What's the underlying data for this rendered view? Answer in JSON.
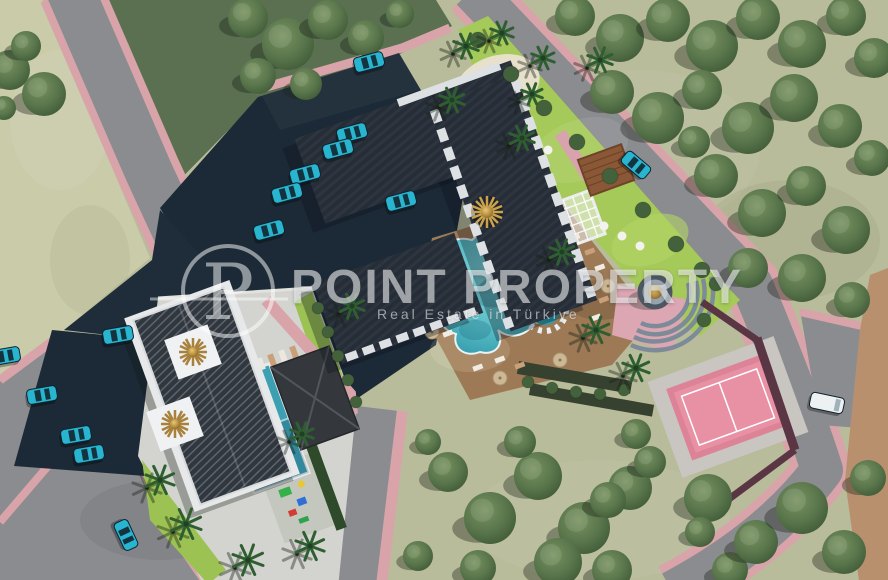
{
  "watermark": {
    "logo_letter": "P",
    "title": "POINT PROPERTY",
    "tagline": "Real Estate in Türkiye"
  },
  "palette": {
    "scrub_grass": "#b8bc9a",
    "pale_field": "#c9cba9",
    "dark_grass": "#5a7050",
    "road_gray": "#8b8c90",
    "sidewalk_pink": "#d8a4a9",
    "curb_maroon": "#6b4048",
    "asphalt_navy": "#1c2a37",
    "roof_charcoal": "#262d36",
    "lawn_green": "#a6ca5a",
    "pool_teal": "#3fa9b8",
    "deck_brown": "#9d7a55",
    "court_pink": "#e2879b",
    "gold": "#b58d3f",
    "car_teal": "#29b4cf",
    "van_white": "#eef1f2",
    "tree_green": "#53714a",
    "palm_green": "#2f5f31",
    "bush_green": "#43613a",
    "tan_strip": "#b9906e",
    "watermark_white": "rgba(255,255,255,0.55)"
  },
  "scene": {
    "label": "aerial-3d-site-plan-render",
    "trees": [
      [
        575,
        16,
        20
      ],
      [
        620,
        38,
        24
      ],
      [
        668,
        20,
        22
      ],
      [
        712,
        46,
        26
      ],
      [
        758,
        18,
        22
      ],
      [
        802,
        44,
        24
      ],
      [
        846,
        16,
        20
      ],
      [
        874,
        58,
        20
      ],
      [
        612,
        92,
        22
      ],
      [
        658,
        118,
        26
      ],
      [
        702,
        90,
        20
      ],
      [
        748,
        128,
        26
      ],
      [
        794,
        98,
        24
      ],
      [
        840,
        126,
        22
      ],
      [
        872,
        158,
        18
      ],
      [
        716,
        176,
        22
      ],
      [
        762,
        213,
        24
      ],
      [
        806,
        186,
        20
      ],
      [
        846,
        230,
        24
      ],
      [
        748,
        268,
        20
      ],
      [
        802,
        278,
        24
      ],
      [
        852,
        300,
        18
      ],
      [
        694,
        142,
        16
      ],
      [
        248,
        18,
        20
      ],
      [
        288,
        44,
        26
      ],
      [
        328,
        20,
        20
      ],
      [
        366,
        38,
        18
      ],
      [
        400,
        14,
        14
      ],
      [
        258,
        76,
        18
      ],
      [
        306,
        84,
        16
      ],
      [
        10,
        70,
        20
      ],
      [
        44,
        94,
        22
      ],
      [
        26,
        46,
        15
      ],
      [
        4,
        108,
        12
      ],
      [
        448,
        472,
        20
      ],
      [
        490,
        518,
        26
      ],
      [
        538,
        476,
        24
      ],
      [
        584,
        528,
        26
      ],
      [
        630,
        488,
        22
      ],
      [
        558,
        562,
        24
      ],
      [
        612,
        570,
        20
      ],
      [
        730,
        570,
        18
      ],
      [
        708,
        498,
        24
      ],
      [
        756,
        542,
        22
      ],
      [
        802,
        508,
        26
      ],
      [
        844,
        552,
        22
      ],
      [
        868,
        478,
        18
      ],
      [
        478,
        568,
        18
      ],
      [
        428,
        442,
        13
      ],
      [
        520,
        442,
        16
      ],
      [
        636,
        434,
        15
      ],
      [
        650,
        462,
        16
      ],
      [
        418,
        556,
        15
      ],
      [
        608,
        500,
        18
      ],
      [
        700,
        532,
        15
      ]
    ],
    "palms": [
      [
        466,
        46,
        13
      ],
      [
        502,
        33,
        12
      ],
      [
        452,
        100,
        13
      ],
      [
        543,
        58,
        12
      ],
      [
        522,
        138,
        13
      ],
      [
        600,
        60,
        13
      ],
      [
        532,
        94,
        11
      ],
      [
        562,
        252,
        13
      ],
      [
        596,
        330,
        14
      ],
      [
        636,
        368,
        14
      ],
      [
        160,
        480,
        15
      ],
      [
        186,
        524,
        16
      ],
      [
        248,
        560,
        16
      ],
      [
        310,
        546,
        15
      ],
      [
        352,
        306,
        13
      ],
      [
        302,
        434,
        12
      ]
    ],
    "bushes": [
      [
        478,
        40,
        8
      ],
      [
        511,
        74,
        8
      ],
      [
        544,
        108,
        8
      ],
      [
        577,
        142,
        8
      ],
      [
        610,
        176,
        8
      ],
      [
        643,
        210,
        8
      ],
      [
        676,
        244,
        8
      ],
      [
        702,
        270,
        8
      ],
      [
        318,
        308,
        6
      ],
      [
        328,
        332,
        6
      ],
      [
        338,
        356,
        6
      ],
      [
        348,
        380,
        6
      ],
      [
        356,
        402,
        6
      ],
      [
        528,
        382,
        6
      ],
      [
        552,
        388,
        6
      ],
      [
        576,
        392,
        6
      ],
      [
        600,
        394,
        6
      ],
      [
        624,
        390,
        6
      ],
      [
        716,
        284,
        7
      ],
      [
        704,
        320,
        7
      ]
    ],
    "cars": [
      {
        "x": 352,
        "y": 133,
        "rot": -15,
        "kind": "car"
      },
      {
        "x": 338,
        "y": 149,
        "rot": -15,
        "kind": "car"
      },
      {
        "x": 305,
        "y": 174,
        "rot": -15,
        "kind": "car"
      },
      {
        "x": 287,
        "y": 193,
        "rot": -15,
        "kind": "car"
      },
      {
        "x": 269,
        "y": 230,
        "rot": -15,
        "kind": "car"
      },
      {
        "x": 401,
        "y": 201,
        "rot": -15,
        "kind": "car"
      },
      {
        "x": 369,
        "y": 62,
        "rot": -15,
        "kind": "car"
      },
      {
        "x": 42,
        "y": 395,
        "rot": -10,
        "kind": "car"
      },
      {
        "x": 76,
        "y": 435,
        "rot": -10,
        "kind": "car"
      },
      {
        "x": 89,
        "y": 454,
        "rot": -10,
        "kind": "car"
      },
      {
        "x": 118,
        "y": 335,
        "rot": -10,
        "kind": "car"
      },
      {
        "x": 5,
        "y": 356,
        "rot": -10,
        "kind": "car"
      },
      {
        "x": 636,
        "y": 165,
        "rot": 40,
        "kind": "car"
      },
      {
        "x": 126,
        "y": 535,
        "rot": 65,
        "kind": "car"
      },
      {
        "x": 827,
        "y": 403,
        "rot": 12,
        "kind": "van"
      }
    ]
  }
}
